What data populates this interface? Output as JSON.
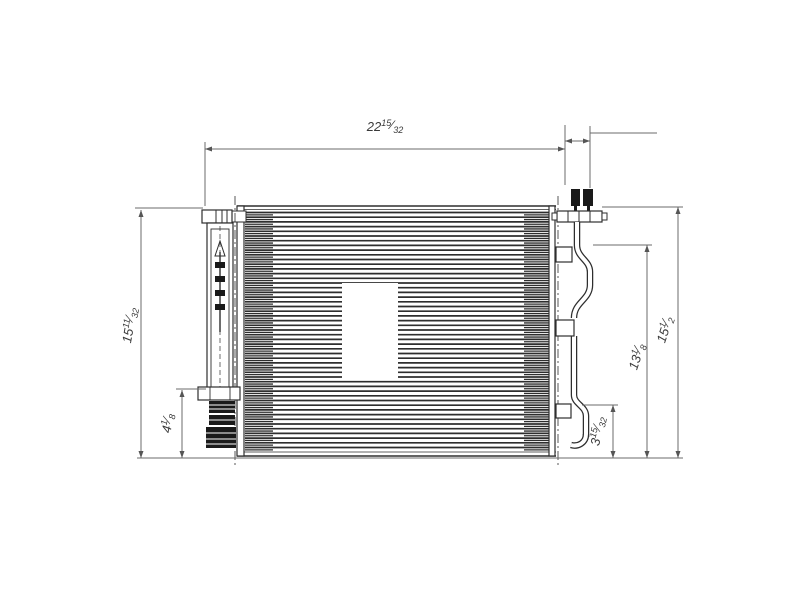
{
  "drawing": {
    "type": "technical-line-drawing",
    "units": "inches",
    "fraction_slash": "⁄",
    "colors": {
      "background": "#ffffff",
      "part_line": "#2e2e2e",
      "dim_line": "#6b6b6b",
      "text": "#3a3a3a",
      "solid_fill": "#1a1a1a"
    },
    "dimensions": {
      "top_width": {
        "whole": "22",
        "num": "15",
        "den": "32",
        "text": "22 15/32"
      },
      "left_height": {
        "whole": "15",
        "num": "11",
        "den": "32",
        "text": "15 11/32"
      },
      "drier_height": {
        "whole": "4",
        "num": "1",
        "den": "8",
        "text": "4 1/8"
      },
      "tube_lower": {
        "whole": "3",
        "num": "15",
        "den": "32",
        "text": "3 15/32"
      },
      "tube_height": {
        "whole": "13",
        "num": "1",
        "den": "8",
        "text": "13 1/8"
      },
      "overall_height": {
        "whole": "15",
        "num": "1",
        "den": "2",
        "text": "15 1/2"
      }
    }
  }
}
